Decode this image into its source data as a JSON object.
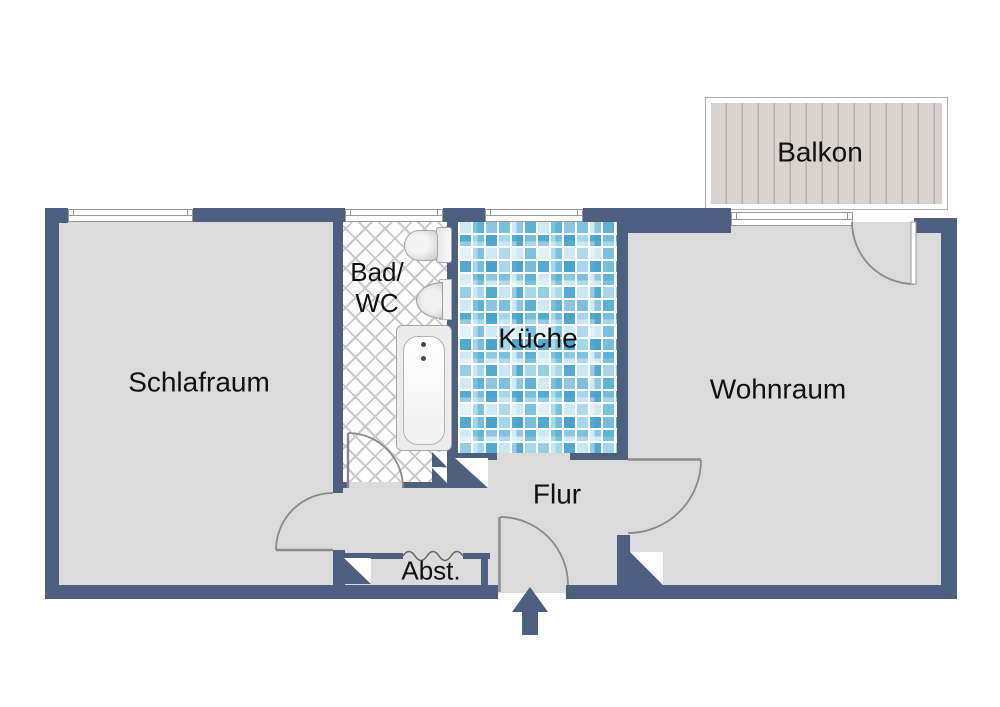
{
  "floorplan": {
    "rooms": {
      "schlafraum": {
        "label": "Schlafraum"
      },
      "bad_wc": {
        "label_line1": "Bad/",
        "label_line2": "WC"
      },
      "kueche": {
        "label": "Küche"
      },
      "wohnraum": {
        "label": "Wohnraum"
      },
      "flur": {
        "label": "Flur"
      },
      "abstellraum": {
        "label": "Abst."
      },
      "balkon": {
        "label": "Balkon"
      }
    },
    "colors": {
      "wall": "#4d6080",
      "floor": "#dbdbdb",
      "deck": "#d9d3cf",
      "deck_line": "#bab2ae",
      "door_stroke": "#8a8a8a",
      "window_line": "#9a9a9a",
      "bad_hatch_line": "#c9c9c9",
      "tile_pale": "#cfeaf6",
      "tile_light": "#a5d8ee",
      "tile_medium": "#79c2e2",
      "tile_dark": "#54aad2",
      "label_text": "#111111"
    }
  }
}
